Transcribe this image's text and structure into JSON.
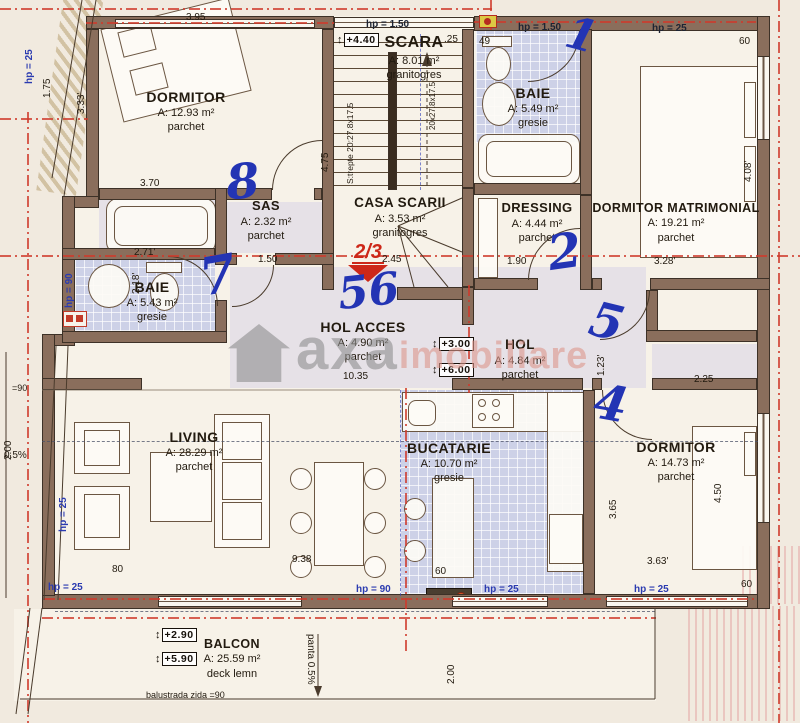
{
  "watermark": {
    "word1": "axa",
    "word2": "imobiliare"
  },
  "section_marker": "2/3",
  "rooms": [
    {
      "id": "dormitor-1",
      "name": "DORMITOR",
      "area": "A: 12.93 m²",
      "floor": "parchet",
      "cx": 186,
      "y": 88,
      "fs": 14
    },
    {
      "id": "scara",
      "name": "SCARA",
      "area": "A: 8.01 m²",
      "floor": "granitogres",
      "cx": 414,
      "y": 33,
      "fs": 16
    },
    {
      "id": "baie-1",
      "name": "BAIE",
      "area": "A: 5.49 m²",
      "floor": "gresie",
      "cx": 533,
      "y": 84,
      "fs": 14
    },
    {
      "id": "dressing",
      "name": "DRESSING",
      "area": "A: 4.44 m²",
      "floor": "parchet",
      "cx": 537,
      "y": 200,
      "fs": 13
    },
    {
      "id": "dormitor-matrimonial",
      "name": "DORMITOR MATRIMONIAL",
      "area": "A: 19.21 m²",
      "floor": "parchet",
      "cx": 676,
      "y": 200,
      "fs": 12.5
    },
    {
      "id": "sas",
      "name": "SAS",
      "area": "A: 2.32 m²",
      "floor": "parchet",
      "cx": 266,
      "y": 198,
      "fs": 13
    },
    {
      "id": "casa-scarii",
      "name": "CASA SCARII",
      "area": "A: 3.53 m²",
      "floor": "granitogres",
      "cx": 400,
      "y": 194,
      "fs": 13.5
    },
    {
      "id": "baie-2",
      "name": "BAIE",
      "area": "A: 5.43 m²",
      "floor": "gresie",
      "cx": 152,
      "y": 278,
      "fs": 14
    },
    {
      "id": "hol-acces",
      "name": "HOL ACCES",
      "area": "A: 4.90 m²",
      "floor": "parchet",
      "cx": 363,
      "y": 318,
      "fs": 14
    },
    {
      "id": "hol",
      "name": "HOL",
      "area": "A: 4.84 m²",
      "floor": "parchet",
      "cx": 520,
      "y": 336,
      "fs": 13.5
    },
    {
      "id": "living",
      "name": "LIVING",
      "area": "A: 28.29 m²",
      "floor": "parchet",
      "cx": 194,
      "y": 428,
      "fs": 14
    },
    {
      "id": "bucatarie",
      "name": "BUCATARIE",
      "area": "A: 10.70 m²",
      "floor": "gresie",
      "cx": 449,
      "y": 439,
      "fs": 14
    },
    {
      "id": "dormitor-2",
      "name": "DORMITOR",
      "area": "A: 14.73 m²",
      "floor": "parchet",
      "cx": 676,
      "y": 438,
      "fs": 14
    },
    {
      "id": "balcon",
      "name": "BALCON",
      "area": "A: 25.59 m²",
      "floor": "deck lemn",
      "cx": 232,
      "y": 636,
      "fs": 12.5
    }
  ],
  "dims": [
    {
      "t": "3.95",
      "x": 186,
      "y": 12,
      "r": 0
    },
    {
      "t": "1.75",
      "x": 42,
      "y": 98,
      "r": -90
    },
    {
      "t": "3.33'",
      "x": 76,
      "y": 114,
      "r": -90
    },
    {
      "t": "3.70",
      "x": 140,
      "y": 178,
      "r": 0
    },
    {
      "t": "2.71'",
      "x": 134,
      "y": 247,
      "r": 0
    },
    {
      "t": "2.18'",
      "x": 131,
      "y": 294,
      "r": -90
    },
    {
      "t": "1.50",
      "x": 258,
      "y": 254,
      "r": 0
    },
    {
      "t": "2.45",
      "x": 382,
      "y": 254,
      "r": 0
    },
    {
      "t": ".25",
      "x": 444,
      "y": 34,
      "r": 0
    },
    {
      "t": "49",
      "x": 479,
      "y": 36,
      "r": 0
    },
    {
      "t": "1.90",
      "x": 507,
      "y": 256,
      "r": 0
    },
    {
      "t": "3.28'",
      "x": 654,
      "y": 256,
      "r": 0
    },
    {
      "t": "60",
      "x": 739,
      "y": 36,
      "r": 0
    },
    {
      "t": "4.08'",
      "x": 743,
      "y": 182,
      "r": -90
    },
    {
      "t": "4.75",
      "x": 320,
      "y": 172,
      "r": -90
    },
    {
      "t": "10.35",
      "x": 343,
      "y": 371,
      "r": 0
    },
    {
      "t": "1.23'",
      "x": 596,
      "y": 376,
      "r": -90
    },
    {
      "t": "2.25",
      "x": 694,
      "y": 374,
      "r": 0
    },
    {
      "t": "9.38",
      "x": 292,
      "y": 554,
      "r": 0
    },
    {
      "t": "80",
      "x": 112,
      "y": 564,
      "r": 0
    },
    {
      "t": "60",
      "x": 435,
      "y": 566,
      "r": 0
    },
    {
      "t": "3.63'",
      "x": 647,
      "y": 556,
      "r": 0
    },
    {
      "t": "3.65",
      "x": 608,
      "y": 519,
      "r": -90
    },
    {
      "t": "60",
      "x": 741,
      "y": 579,
      "r": 0
    },
    {
      "t": "4.50",
      "x": 713,
      "y": 503,
      "r": -90
    },
    {
      "t": "2.00",
      "x": 3,
      "y": 460,
      "r": -90
    },
    {
      "t": "2.00",
      "x": 446,
      "y": 684,
      "r": -90
    }
  ],
  "hp_labels": [
    {
      "t": "hp = 1.50",
      "x": 366,
      "y": 19,
      "r": 0,
      "c": "k"
    },
    {
      "t": "hp = 1.50",
      "x": 518,
      "y": 22,
      "r": 0,
      "c": "k"
    },
    {
      "t": "hp = 25",
      "x": 652,
      "y": 23,
      "r": 0,
      "c": "k"
    },
    {
      "t": "hp = 25",
      "x": 24,
      "y": 84,
      "r": -90,
      "c": "b"
    },
    {
      "t": "hp = 25",
      "x": 58,
      "y": 532,
      "r": -90,
      "c": "b"
    },
    {
      "t": "hp = 90",
      "x": 64,
      "y": 308,
      "r": -90,
      "c": "b"
    },
    {
      "t": "hp = 25",
      "x": 48,
      "y": 582,
      "r": 0,
      "c": "b"
    },
    {
      "t": "hp = 90",
      "x": 356,
      "y": 584,
      "r": 0,
      "c": "b"
    },
    {
      "t": "hp = 25",
      "x": 484,
      "y": 584,
      "r": 0,
      "c": "b"
    },
    {
      "t": "hp = 25",
      "x": 634,
      "y": 584,
      "r": 0,
      "c": "b"
    }
  ],
  "levels": [
    {
      "t": "+4.40",
      "x": 337,
      "y": 33
    },
    {
      "t": "+3.00",
      "x": 432,
      "y": 337
    },
    {
      "t": "+6.00",
      "x": 432,
      "y": 363
    },
    {
      "t": "+2.90",
      "x": 155,
      "y": 628
    },
    {
      "t": "+5.90",
      "x": 155,
      "y": 652
    }
  ],
  "handwritten": [
    {
      "t": "8",
      "x": 226,
      "y": 158,
      "s": 48,
      "r": -5
    },
    {
      "t": "1",
      "x": 566,
      "y": 14,
      "s": 44,
      "r": 15
    },
    {
      "t": "2",
      "x": 548,
      "y": 228,
      "s": 48,
      "r": -8
    },
    {
      "t": "7",
      "x": 200,
      "y": 250,
      "s": 52,
      "r": -10
    },
    {
      "t": "56",
      "x": 338,
      "y": 270,
      "s": 44,
      "r": -6
    },
    {
      "t": "5",
      "x": 590,
      "y": 298,
      "s": 48,
      "r": 14
    },
    {
      "t": "4",
      "x": 594,
      "y": 380,
      "s": 48,
      "r": 10
    }
  ],
  "notes": [
    {
      "t": "S:trepte 20:27.8x17.5",
      "x": 345,
      "y": 184,
      "r": -90,
      "s": 8.5
    },
    {
      "t": "20x27.8x17.5",
      "x": 428,
      "y": 130,
      "r": -90,
      "s": 8
    },
    {
      "t": "panta 0.5%",
      "x": 316,
      "y": 634,
      "r": 90,
      "s": 10
    },
    {
      "t": "balustrada zida =90",
      "x": 146,
      "y": 690,
      "r": 0,
      "s": 9
    },
    {
      "t": "0.5%",
      "x": 4,
      "y": 450,
      "r": 0,
      "s": 10
    },
    {
      "t": "=90",
      "x": 12,
      "y": 383,
      "r": 0,
      "s": 9
    }
  ]
}
